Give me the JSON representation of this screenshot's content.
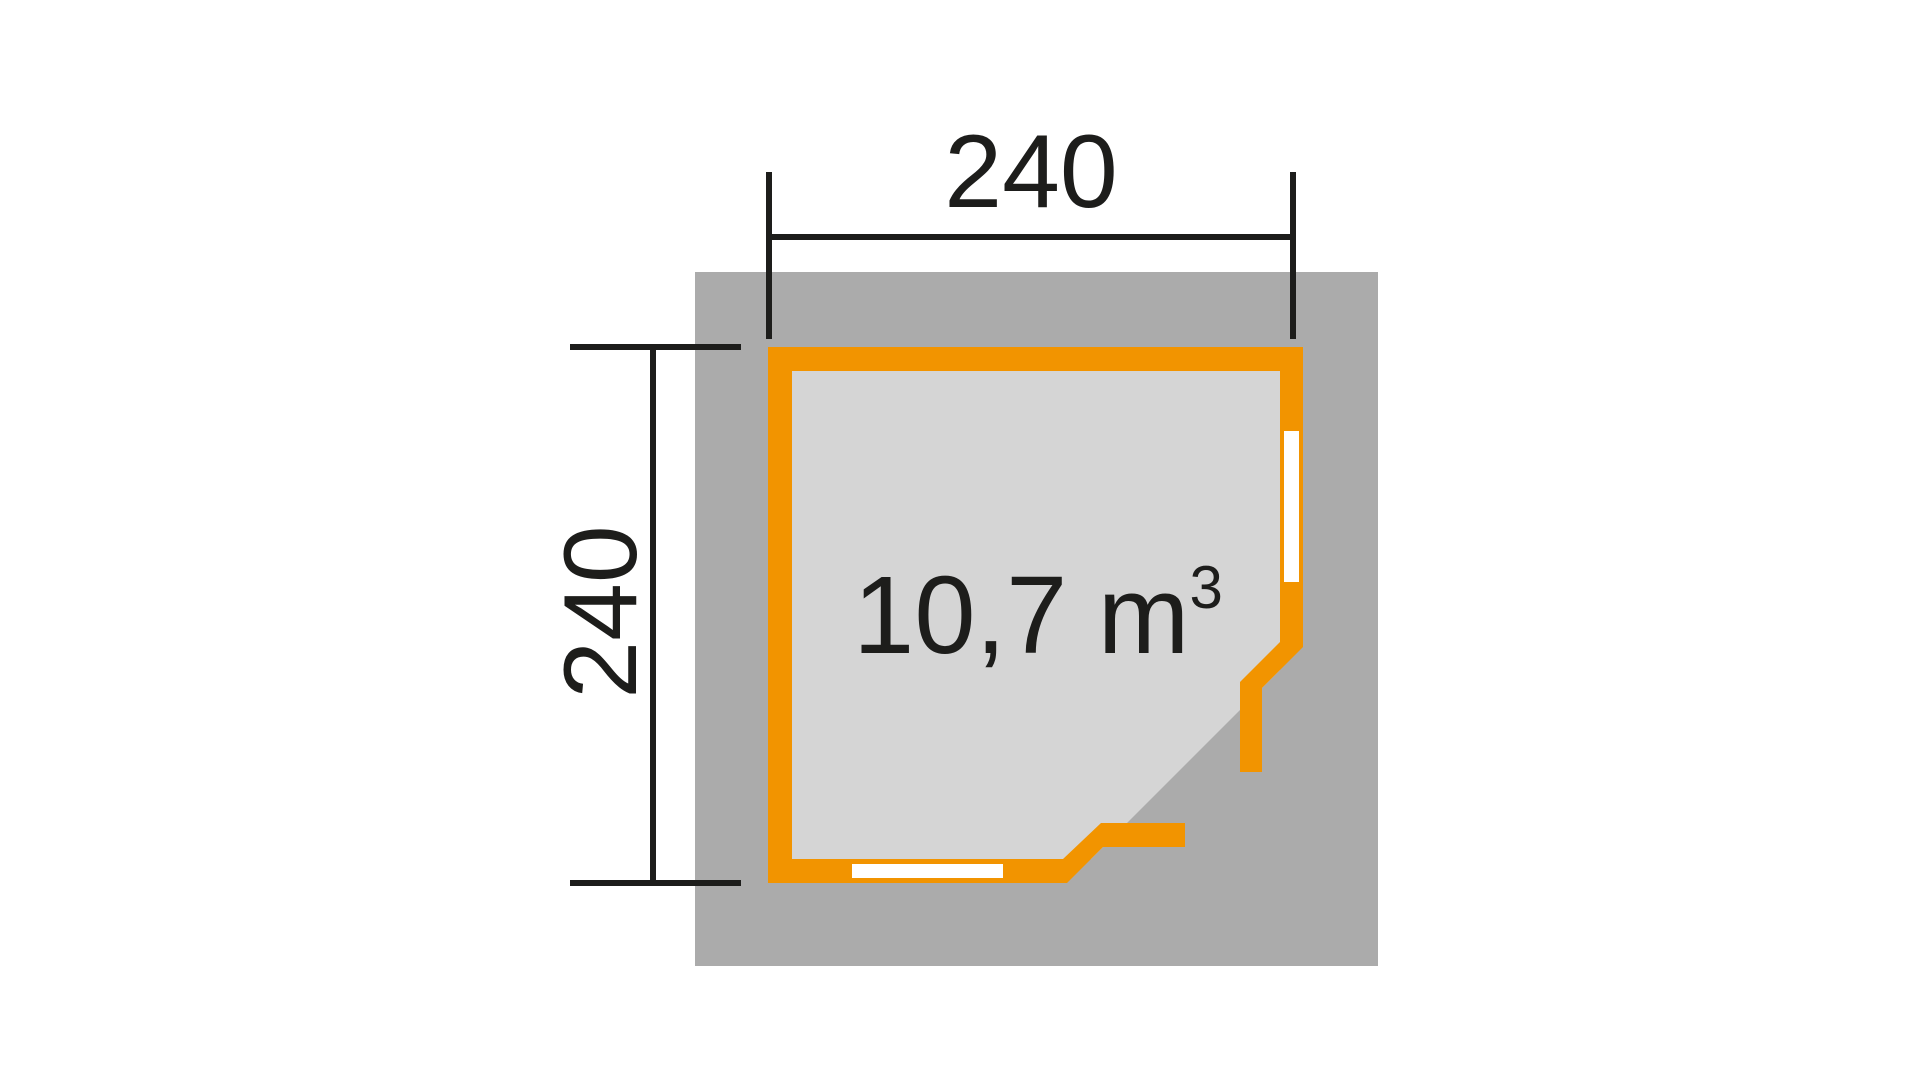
{
  "colors": {
    "orange": "#F29400",
    "roof_gray": "#ABABAB",
    "floor_gray": "#D5D5D5",
    "window_white": "#FFFFFF",
    "ink": "#1D1D1B",
    "background": "#FFFFFF"
  },
  "dimensions": {
    "top_label": "240",
    "left_label": "240"
  },
  "volume": {
    "label": "10,7 m",
    "exponent": "3"
  },
  "plan": {
    "base_rect": {
      "x": "695",
      "y": "272",
      "width": "683",
      "height": "694"
    },
    "floor_points": "792,371 1280,371 1280,670 1091,859 792,859",
    "wall_points": "768,347 1303,347 1303,647 1262,688 1262,772 1240,772 1240,682 1280,642 1280,371 792,371 792,859 1063,859 1101,823 1185,823 1185,847 1103,847 1067,883 768,883",
    "window_right": {
      "x": "1284",
      "y": "431",
      "width": "15",
      "height": "151"
    },
    "window_bottom": {
      "x": "852",
      "y": "864",
      "width": "151",
      "height": "14"
    },
    "dim_top": {
      "line": {
        "x1": "769",
        "y1": "237",
        "x2": "1293",
        "y2": "237"
      },
      "tick_left": {
        "x1": "769",
        "y1": "172",
        "x2": "769",
        "y2": "339"
      },
      "tick_right": {
        "x1": "1293",
        "y1": "172",
        "x2": "1293",
        "y2": "339"
      }
    },
    "dim_left": {
      "line": {
        "x1": "653",
        "y1": "347",
        "x2": "653",
        "y2": "883"
      },
      "tick_top": {
        "x1": "570",
        "y1": "347",
        "x2": "741",
        "y2": "347"
      },
      "tick_bottom": {
        "x1": "570",
        "y1": "883",
        "x2": "741",
        "y2": "883"
      }
    }
  }
}
